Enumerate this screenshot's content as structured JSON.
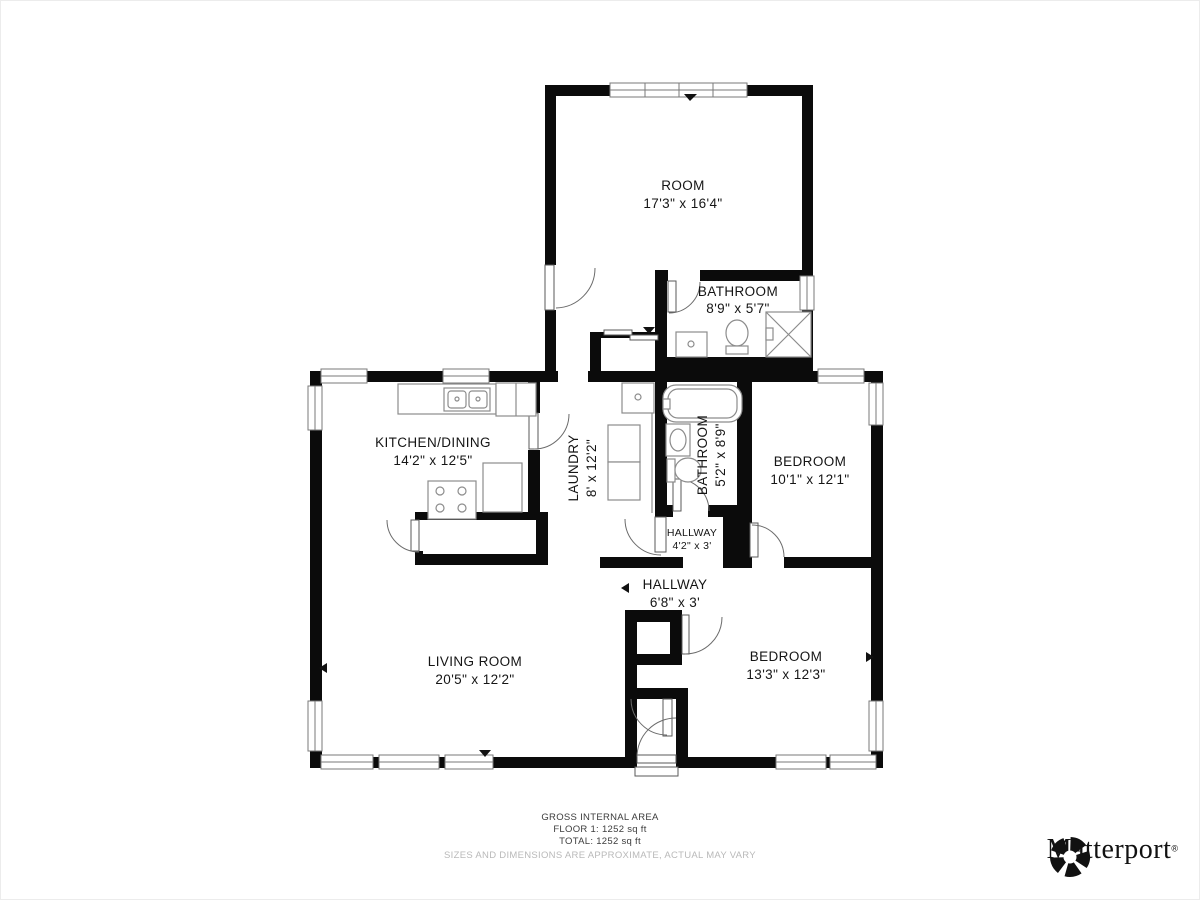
{
  "rooms": {
    "room": {
      "name": "ROOM",
      "dims": "17'3\" x 16'4\""
    },
    "bathroom_top": {
      "name": "BATHROOM",
      "dims": "8'9\" x 5'7\""
    },
    "kitchen": {
      "name": "KITCHEN/DINING",
      "dims": "14'2\" x 12'5\""
    },
    "laundry": {
      "name": "LAUNDRY",
      "dims": "8' x 12'2\""
    },
    "bathroom_mid": {
      "name": "BATHROOM",
      "dims": "5'2\" x 8'9\""
    },
    "bedroom_right": {
      "name": "BEDROOM",
      "dims": "10'1\" x 12'1\""
    },
    "hallway_small": {
      "name": "HALLWAY",
      "dims": "4'2\" x 3'"
    },
    "hallway_main": {
      "name": "HALLWAY",
      "dims": "6'8\" x 3'"
    },
    "living": {
      "name": "LIVING ROOM",
      "dims": "20'5\" x 12'2\""
    },
    "bedroom_bottom": {
      "name": "BEDROOM",
      "dims": "13'3\" x 12'3\""
    }
  },
  "footer": {
    "line1": "GROSS INTERNAL AREA",
    "line2": "FLOOR 1: 1252 sq ft",
    "line3": "TOTAL: 1252 sq ft",
    "disclaimer": "SIZES AND DIMENSIONS ARE APPROXIMATE, ACTUAL MAY VARY"
  },
  "branding": {
    "logo_text": "Matterport",
    "registered_mark": "®"
  },
  "colors": {
    "wall": "#0b0b0b",
    "fixture": "#8c8c8c",
    "disclaimer_text": "#b9b9b9"
  }
}
